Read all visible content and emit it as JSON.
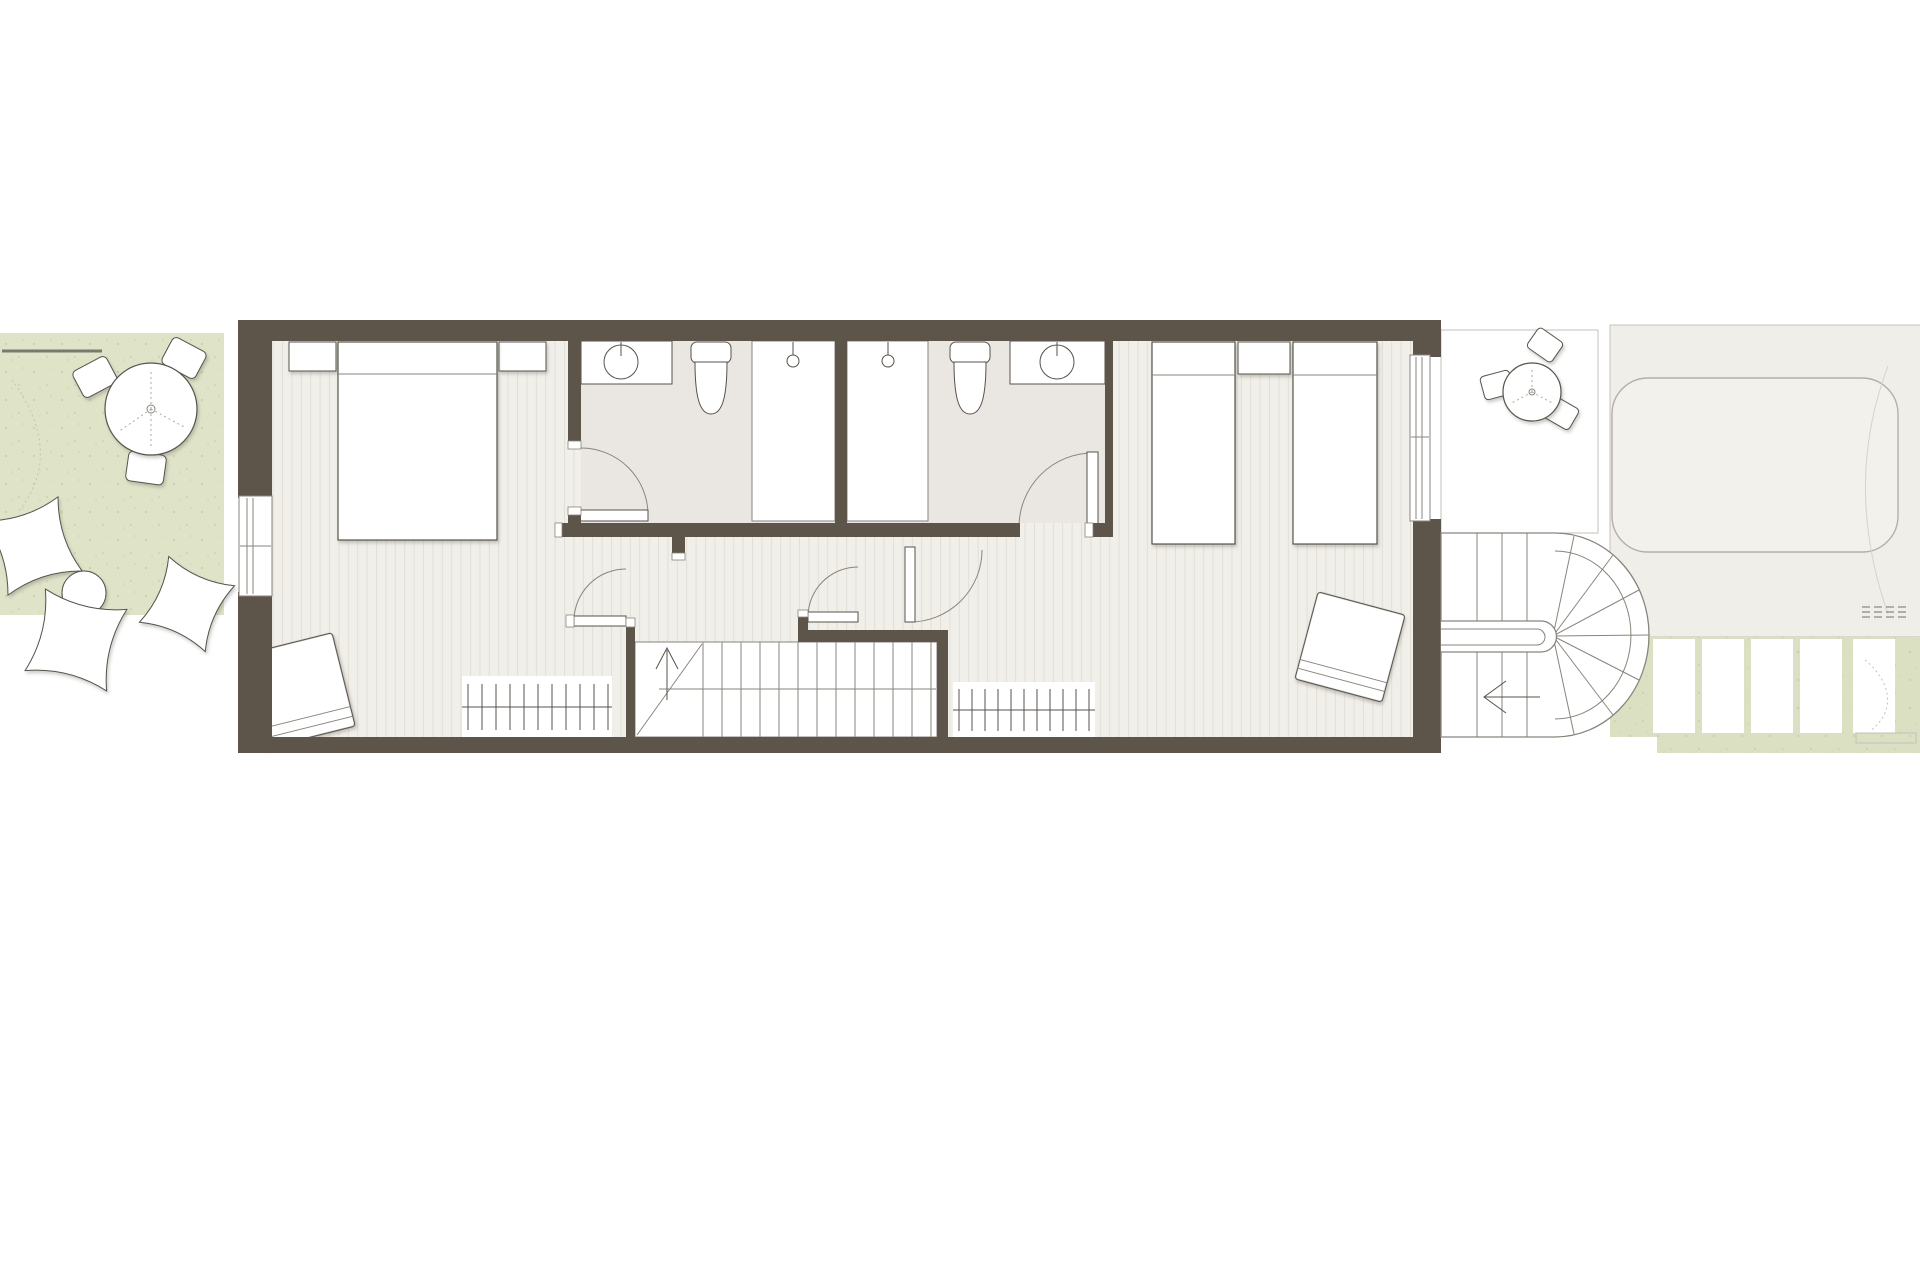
{
  "meta": {
    "kind": "architectural-floor-plan",
    "storey": "bedroom floor of a narrow terraced house with front garden, rear terrace, spiral stair, lap pool",
    "canvas_px": {
      "width": 1920,
      "height": 1280
    },
    "visible_text": "none"
  },
  "colors": {
    "background": "#ffffff",
    "wall": "#5e554a",
    "floor_plank": "#f1efe9",
    "plank_line": "#e3dfd7",
    "bathroom_floor": "#eae7e2",
    "outline_dark": "#57524b",
    "outline_soft": "#8a857c",
    "hairline": "#c4c1b9",
    "garden_green": "#dfe3c8",
    "speckle": "#c9cdaa",
    "terrace": "#e8e6e0",
    "pool_deck": "#f0eee8",
    "pool_water": "#f3f1ec",
    "pool_edge": "#b3b0a8",
    "rear_green": "#dbe0c3",
    "furniture": "#ffffff"
  },
  "areas": {
    "front_garden": {
      "items": [
        "boundary-fence-line",
        "round-dining-table",
        "garden-chair",
        "garden-chair",
        "garden-chair",
        "floor-cushion",
        "floor-cushion",
        "floor-cushion",
        "pouf-circle",
        "pouf-circle"
      ]
    },
    "master_bedroom": {
      "items": [
        "double-bed",
        "nightstand",
        "nightstand",
        "lounge-chair",
        "radiator",
        "window-left-wall"
      ]
    },
    "bathroom_left": {
      "items": [
        "vanity-counter-basin",
        "tap",
        "toilet",
        "walk-in-shower",
        "shower-head",
        "swing-door"
      ]
    },
    "bathroom_right": {
      "items": [
        "walk-in-shower",
        "shower-head",
        "toilet",
        "vanity-counter-basin",
        "tap",
        "swing-door"
      ]
    },
    "twin_bedroom": {
      "items": [
        "single-bed",
        "single-bed",
        "nightstand",
        "lounge-chair",
        "window-right-wall"
      ]
    },
    "landing": {
      "items": [
        "main-staircase",
        "swing-door",
        "swing-door",
        "swing-door",
        "radiator"
      ]
    },
    "rear_terrace": {
      "items": [
        "round-bistro-table",
        "terrace-chair",
        "terrace-chair",
        "terrace-chair"
      ]
    },
    "rear_spiral_stair": {
      "items": [
        "winder-staircase",
        "handrail-capsule",
        "direction-arrow-left"
      ]
    },
    "pool_area": {
      "items": [
        "lap-pool",
        "pool-deck",
        "drain-grate"
      ]
    },
    "rear_garden": {
      "items": [
        "boardwalk-plank",
        "boardwalk-plank",
        "boardwalk-plank",
        "boardwalk-plank",
        "boardwalk-plank",
        "bench-board"
      ]
    }
  },
  "stairs": {
    "main": {
      "tread_count": 13,
      "direction_arrow": "up",
      "break_line": true
    },
    "spiral": {
      "straight_treads": 6,
      "winder_treads": 7,
      "direction_arrow": "left"
    }
  }
}
